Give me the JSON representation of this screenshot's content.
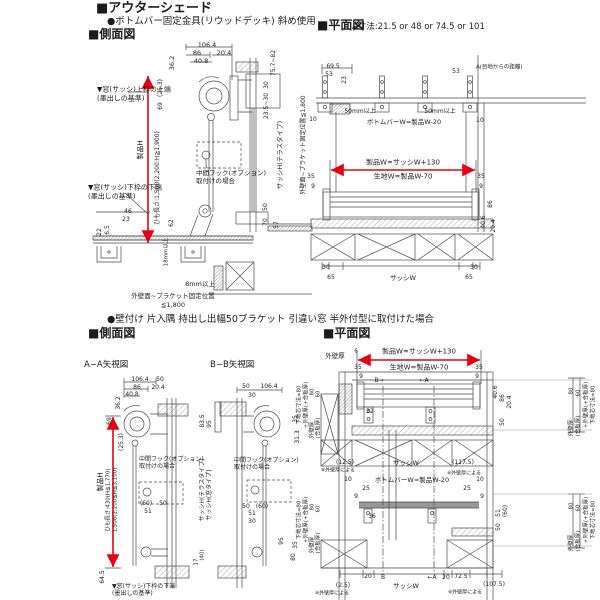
{
  "header": {
    "title": "■アウターシェード",
    "subtitle": "●ボトムバー固定金具(リウッドデッキ) 斜め使用",
    "side_view_label": "■側面図"
  },
  "plan_top": {
    "label": "■平面図",
    "note": "A寸法:21.5 or 48 or 74.5 or 101"
  },
  "mid_header": {
    "bullet": "●壁付け 片入隅 持出し出幅50ブラケット 引違い窓 半外付型に取付けた場合",
    "side_view_label": "■側面図",
    "plan_view_label": "■平面図"
  },
  "sub_views": {
    "aa_label": "A−A矢視図",
    "bb_label": "B−B矢視図"
  },
  "colors": {
    "accent_red": "#e60012",
    "line": "#4a4a4a"
  },
  "labels": [
    {
      "t": "106.4",
      "x": 207,
      "y": 45,
      "s": 6.5
    },
    {
      "t": "86",
      "x": 197,
      "y": 53,
      "s": 6.5
    },
    {
      "t": "20.4",
      "x": 224,
      "y": 53,
      "s": 6.5
    },
    {
      "t": "40.8",
      "x": 201,
      "y": 61,
      "s": 6.5
    },
    {
      "t": "36.2",
      "x": 172,
      "y": 63,
      "r": -90,
      "s": 6.5
    },
    {
      "t": "▼窓(サッシ)上枠の上端",
      "x": 97,
      "y": 90,
      "a": "l",
      "s": 7
    },
    {
      "t": "(墨出しの基準)",
      "x": 97,
      "y": 99,
      "a": "l",
      "s": 7
    },
    {
      "t": "(25.3)",
      "x": 161,
      "y": 88,
      "r": -90,
      "s": 6
    },
    {
      "t": "69",
      "x": 161,
      "y": 106,
      "r": -90,
      "s": 6
    },
    {
      "t": "製品H",
      "x": 141,
      "y": 150,
      "r": -90,
      "s": 7
    },
    {
      "t": "ひも長さ:1,500(2,200:H≧1,900)",
      "x": 158,
      "y": 178,
      "r": -90,
      "s": 6
    },
    {
      "t": "中間フック(オプション)",
      "x": 196,
      "y": 173,
      "a": "l",
      "s": 6.5
    },
    {
      "t": "取付けの場合",
      "x": 196,
      "y": 181,
      "a": "l",
      "s": 6.5
    },
    {
      "t": "75.7~82",
      "x": 274,
      "y": 63,
      "r": -90,
      "s": 6
    },
    {
      "t": "30",
      "x": 267,
      "y": 85,
      "r": -90,
      "s": 6
    },
    {
      "t": "23.5~30",
      "x": 267,
      "y": 106,
      "r": -90,
      "s": 6
    },
    {
      "t": "サッシH(テラスタイプ)",
      "x": 280,
      "y": 155,
      "r": -90,
      "s": 6.5
    },
    {
      "t": "50",
      "x": 266,
      "y": 207,
      "r": -90,
      "s": 6
    },
    {
      "t": "70",
      "x": 266,
      "y": 222,
      "r": -90,
      "s": 6
    },
    {
      "t": "57",
      "x": 277,
      "y": 225,
      "r": -90,
      "s": 6
    },
    {
      "t": "▼窓(サッシ)下枠の下端",
      "x": 88,
      "y": 188,
      "a": "l",
      "s": 7
    },
    {
      "t": "(墨出しの基準)",
      "x": 88,
      "y": 197,
      "a": "l",
      "s": 7
    },
    {
      "t": "46",
      "x": 128,
      "y": 212,
      "s": 6
    },
    {
      "t": "23",
      "x": 126,
      "y": 220,
      "s": 6
    },
    {
      "t": "22",
      "x": 100,
      "y": 232,
      "r": -90,
      "s": 6
    },
    {
      "t": "6.5",
      "x": 108,
      "y": 230,
      "r": -90,
      "s": 6
    },
    {
      "t": "62",
      "x": 172,
      "y": 223,
      "r": -90,
      "s": 6
    },
    {
      "t": "18mm以上",
      "x": 167,
      "y": 252,
      "r": -90,
      "s": 5.5
    },
    {
      "t": "8mm以上",
      "x": 200,
      "y": 284,
      "s": 6.5
    },
    {
      "t": "外壁面~ブラケット固定位置",
      "x": 173,
      "y": 296,
      "s": 6.5
    },
    {
      "t": "≦1,800",
      "x": 173,
      "y": 305,
      "s": 6.5
    },
    {
      "t": "外壁面~ブラケット固定位置≦1,800",
      "x": 304,
      "y": 145,
      "r": -90,
      "s": 6
    },
    {
      "t": "69.5",
      "x": 333,
      "y": 67,
      "s": 6
    },
    {
      "t": "53",
      "x": 329,
      "y": 75,
      "s": 6
    },
    {
      "t": "23",
      "x": 345,
      "y": 80,
      "r": -90,
      "s": 6
    },
    {
      "t": "53",
      "x": 456,
      "y": 72,
      "s": 6
    },
    {
      "t": "A(目地からの距離)",
      "x": 476,
      "y": 68,
      "a": "l",
      "s": 5.5
    },
    {
      "t": "50mm以上",
      "x": 360,
      "y": 112,
      "s": 6
    },
    {
      "t": "50mm以上",
      "x": 440,
      "y": 112,
      "s": 6
    },
    {
      "t": "ボトムバーW=製品W-20",
      "x": 404,
      "y": 122,
      "s": 6.5
    },
    {
      "t": "10",
      "x": 313,
      "y": 120,
      "s": 6
    },
    {
      "t": "10",
      "x": 480,
      "y": 121,
      "s": 6
    },
    {
      "t": "製品W=サッシW+130",
      "x": 403,
      "y": 163,
      "s": 7
    },
    {
      "t": "生地W=製品W-70",
      "x": 403,
      "y": 177,
      "s": 7
    },
    {
      "t": "35",
      "x": 311,
      "y": 177,
      "s": 6
    },
    {
      "t": "35",
      "x": 481,
      "y": 177,
      "s": 6
    },
    {
      "t": "9",
      "x": 313,
      "y": 187,
      "s": 6
    },
    {
      "t": "9",
      "x": 481,
      "y": 187,
      "s": 6
    },
    {
      "t": "86",
      "x": 491,
      "y": 204,
      "r": -90,
      "s": 6
    },
    {
      "t": "40.6",
      "x": 484,
      "y": 222,
      "r": -90,
      "s": 6
    },
    {
      "t": "20.4",
      "x": 494,
      "y": 226,
      "r": -90,
      "s": 6
    },
    {
      "t": "30",
      "x": 326,
      "y": 268,
      "s": 6
    },
    {
      "t": "65",
      "x": 331,
      "y": 278,
      "s": 6
    },
    {
      "t": "サッシW",
      "x": 403,
      "y": 278,
      "s": 6.5
    },
    {
      "t": "65",
      "x": 469,
      "y": 278,
      "s": 6
    },
    {
      "t": "30",
      "x": 474,
      "y": 268,
      "s": 6
    },
    {
      "t": "106.4",
      "x": 140,
      "y": 380,
      "s": 6
    },
    {
      "t": "50",
      "x": 160,
      "y": 380,
      "s": 6
    },
    {
      "t": "86",
      "x": 137,
      "y": 388,
      "s": 6
    },
    {
      "t": "20.4",
      "x": 158,
      "y": 388,
      "s": 6
    },
    {
      "t": "40.8",
      "x": 132,
      "y": 395,
      "s": 6
    },
    {
      "t": "36.2",
      "x": 119,
      "y": 403,
      "r": -90,
      "s": 6
    },
    {
      "t": "69",
      "x": 110,
      "y": 421,
      "r": -90,
      "s": 6
    },
    {
      "t": "(25.3)",
      "x": 122,
      "y": 442,
      "r": -90,
      "s": 6
    },
    {
      "t": "製品H",
      "x": 101,
      "y": 482,
      "r": -90,
      "s": 7
    },
    {
      "t": "ひも長さ:430(H≦1,770)",
      "x": 109,
      "y": 500,
      "r": -90,
      "s": 5.5
    },
    {
      "t": "1,500(2,200≦H≦3,100)",
      "x": 116,
      "y": 500,
      "r": -90,
      "s": 5.5
    },
    {
      "t": "中間フック(オプション)",
      "x": 139,
      "y": 460,
      "a": "l",
      "s": 6
    },
    {
      "t": "取付けの場合",
      "x": 139,
      "y": 467,
      "a": "l",
      "s": 6
    },
    {
      "t": "(60)",
      "x": 146,
      "y": 504,
      "s": 6
    },
    {
      "t": "50",
      "x": 163,
      "y": 504,
      "s": 6
    },
    {
      "t": "51",
      "x": 148,
      "y": 512,
      "s": 6
    },
    {
      "t": "83.5",
      "x": 203,
      "y": 421,
      "r": -90,
      "s": 6
    },
    {
      "t": "95",
      "x": 210,
      "y": 424,
      "r": -90,
      "s": 6
    },
    {
      "t": "サッシH(テラスタイプ)",
      "x": 203,
      "y": 490,
      "r": -90,
      "s": 6
    },
    {
      "t": "サッシH(窓タイプ)",
      "x": 210,
      "y": 495,
      "r": -90,
      "s": 6
    },
    {
      "t": "95",
      "x": 282,
      "y": 541,
      "r": -90,
      "s": 6
    },
    {
      "t": "(40)",
      "x": 203,
      "y": 555,
      "r": -90,
      "s": 5.5
    },
    {
      "t": "17",
      "x": 197,
      "y": 562,
      "r": -90,
      "s": 5.5
    },
    {
      "t": "64.5",
      "x": 103,
      "y": 577,
      "r": -90,
      "s": 6
    },
    {
      "t": "▼窓(サッシ)下枠の下端",
      "x": 112,
      "y": 587,
      "a": "l",
      "s": 6
    },
    {
      "t": "(墨出しの基準)",
      "x": 112,
      "y": 594,
      "a": "l",
      "s": 6
    },
    {
      "t": "50",
      "x": 246,
      "y": 387,
      "s": 6
    },
    {
      "t": "106.4",
      "x": 269,
      "y": 387,
      "s": 6
    },
    {
      "t": "30",
      "x": 252,
      "y": 396,
      "s": 6
    },
    {
      "t": "35",
      "x": 296,
      "y": 419,
      "r": -90,
      "s": 6
    },
    {
      "t": "31.3",
      "x": 298,
      "y": 437,
      "r": -90,
      "s": 6
    },
    {
      "t": "中間フック(オプション)",
      "x": 234,
      "y": 461,
      "a": "l",
      "s": 6
    },
    {
      "t": "取付けの場合",
      "x": 234,
      "y": 468,
      "a": "l",
      "s": 6
    },
    {
      "t": "50",
      "x": 246,
      "y": 507,
      "s": 6
    },
    {
      "t": "(60)",
      "x": 262,
      "y": 507,
      "s": 6
    },
    {
      "t": "51",
      "x": 252,
      "y": 514,
      "s": 6
    },
    {
      "t": "30",
      "x": 252,
      "y": 522,
      "s": 6
    },
    {
      "t": "35",
      "x": 296,
      "y": 545,
      "r": -90,
      "s": 6
    },
    {
      "t": "80",
      "x": 294,
      "y": 557,
      "r": -90,
      "s": 6
    },
    {
      "t": "下地芯寸法=80",
      "x": 300,
      "y": 405,
      "r": -90,
      "s": 5.5
    },
    {
      "t": "+外壁厚(+合板厚)",
      "x": 307,
      "y": 405,
      "r": -90,
      "s": 5.5
    },
    {
      "t": "80",
      "x": 313,
      "y": 392,
      "r": -90,
      "s": 5.5
    },
    {
      "t": "60",
      "x": 319,
      "y": 394,
      "r": -90,
      "s": 5.5
    },
    {
      "t": "外壁厚",
      "x": 313,
      "y": 430,
      "r": -90,
      "s": 5.5
    },
    {
      "t": "(合板厚)",
      "x": 319,
      "y": 428,
      "r": -90,
      "s": 5.5
    },
    {
      "t": "下地芯寸法=80",
      "x": 300,
      "y": 520,
      "r": -90,
      "s": 5.5
    },
    {
      "t": "+外壁厚(+合板厚)",
      "x": 307,
      "y": 520,
      "r": -90,
      "s": 5.5
    },
    {
      "t": "80",
      "x": 313,
      "y": 507,
      "r": -90,
      "s": 5.5
    },
    {
      "t": "60",
      "x": 319,
      "y": 509,
      "r": -90,
      "s": 5.5
    },
    {
      "t": "外壁厚",
      "x": 313,
      "y": 545,
      "r": -90,
      "s": 5.5
    },
    {
      "t": "(合板厚)",
      "x": 319,
      "y": 543,
      "r": -90,
      "s": 5.5
    },
    {
      "t": "外壁厚",
      "x": 335,
      "y": 356,
      "s": 6.5
    },
    {
      "t": "6",
      "x": 356,
      "y": 352,
      "s": 5.5
    },
    {
      "t": "製品W=サッシW+130",
      "x": 419,
      "y": 352,
      "s": 7
    },
    {
      "t": "生地W=製品W-70",
      "x": 419,
      "y": 368,
      "s": 7
    },
    {
      "t": "35",
      "x": 358,
      "y": 368,
      "s": 6
    },
    {
      "t": "35",
      "x": 479,
      "y": 368,
      "s": 6
    },
    {
      "t": "9",
      "x": 361,
      "y": 377,
      "s": 6
    },
    {
      "t": "9",
      "x": 477,
      "y": 377,
      "s": 6
    },
    {
      "t": "B→",
      "x": 379,
      "y": 381,
      "s": 6
    },
    {
      "t": "←A",
      "x": 424,
      "y": 381,
      "s": 6
    },
    {
      "t": "32",
      "x": 370,
      "y": 412,
      "s": 6
    },
    {
      "t": "40.6",
      "x": 496,
      "y": 392,
      "r": -90,
      "s": 6
    },
    {
      "t": "86",
      "x": 503,
      "y": 398,
      "r": -90,
      "s": 6
    },
    {
      "t": "20.4",
      "x": 510,
      "y": 402,
      "r": -90,
      "s": 6
    },
    {
      "t": "50",
      "x": 503,
      "y": 422,
      "r": -90,
      "s": 6
    },
    {
      "t": "(12.5)",
      "x": 345,
      "y": 463,
      "s": 6
    },
    {
      "t": "サッシW",
      "x": 406,
      "y": 463,
      "s": 6.5
    },
    {
      "t": "(117.5)",
      "x": 463,
      "y": 463,
      "s": 6
    },
    {
      "t": "※外壁厚による",
      "x": 338,
      "y": 471,
      "s": 5
    },
    {
      "t": "※外壁厚による",
      "x": 464,
      "y": 474,
      "s": 5
    },
    {
      "t": "10",
      "x": 348,
      "y": 480,
      "s": 6
    },
    {
      "t": "ボトムバーW=製品W-20",
      "x": 412,
      "y": 480,
      "s": 6.5
    },
    {
      "t": "10",
      "x": 480,
      "y": 480,
      "s": 6
    },
    {
      "t": "25",
      "x": 366,
      "y": 489,
      "s": 6
    },
    {
      "t": "25",
      "x": 467,
      "y": 489,
      "s": 6
    },
    {
      "t": "9",
      "x": 356,
      "y": 497,
      "s": 6
    },
    {
      "t": "9",
      "x": 482,
      "y": 497,
      "s": 6
    },
    {
      "t": "36",
      "x": 372,
      "y": 517,
      "s": 6
    },
    {
      "t": "51",
      "x": 499,
      "y": 513,
      "r": -90,
      "s": 6
    },
    {
      "t": "(60)",
      "x": 506,
      "y": 511,
      "r": -90,
      "s": 6
    },
    {
      "t": "50",
      "x": 499,
      "y": 527,
      "r": -90,
      "s": 6
    },
    {
      "t": "20",
      "x": 368,
      "y": 577,
      "s": 6
    },
    {
      "t": "B",
      "x": 383,
      "y": 578,
      "s": 6
    },
    {
      "t": "←A",
      "x": 432,
      "y": 578,
      "s": 6
    },
    {
      "t": "20",
      "x": 446,
      "y": 578,
      "s": 6
    },
    {
      "t": "72.5",
      "x": 461,
      "y": 577,
      "s": 6
    },
    {
      "t": "(2.5)",
      "x": 343,
      "y": 586,
      "s": 6
    },
    {
      "t": "サッシW",
      "x": 406,
      "y": 586,
      "s": 6.5
    },
    {
      "t": "(107.5)",
      "x": 494,
      "y": 585,
      "s": 6
    },
    {
      "t": "※外壁厚による",
      "x": 332,
      "y": 594,
      "s": 5
    },
    {
      "t": "※外壁厚による",
      "x": 465,
      "y": 593,
      "s": 5
    },
    {
      "t": "80",
      "x": 572,
      "y": 391,
      "r": -90,
      "s": 5.5
    },
    {
      "t": "60",
      "x": 579,
      "y": 393,
      "r": -90,
      "s": 5.5
    },
    {
      "t": "外壁厚",
      "x": 572,
      "y": 428,
      "r": -90,
      "s": 5.5
    },
    {
      "t": "(合板厚)",
      "x": 579,
      "y": 426,
      "r": -90,
      "s": 5.5
    },
    {
      "t": "+外壁厚(+合板厚)",
      "x": 587,
      "y": 405,
      "r": -90,
      "s": 5.5
    },
    {
      "t": "下地芯寸法=80",
      "x": 594,
      "y": 405,
      "r": -90,
      "s": 5.5
    },
    {
      "t": "80",
      "x": 572,
      "y": 506,
      "r": -90,
      "s": 5.5
    },
    {
      "t": "60",
      "x": 579,
      "y": 508,
      "r": -90,
      "s": 5.5
    },
    {
      "t": "外壁厚",
      "x": 572,
      "y": 543,
      "r": -90,
      "s": 5.5
    },
    {
      "t": "(合板厚)",
      "x": 579,
      "y": 541,
      "r": -90,
      "s": 5.5
    },
    {
      "t": "+外壁厚(+合板厚)",
      "x": 587,
      "y": 520,
      "r": -90,
      "s": 5.5
    },
    {
      "t": "下地芯寸法=80",
      "x": 594,
      "y": 520,
      "r": -90,
      "s": 5.5
    }
  ]
}
